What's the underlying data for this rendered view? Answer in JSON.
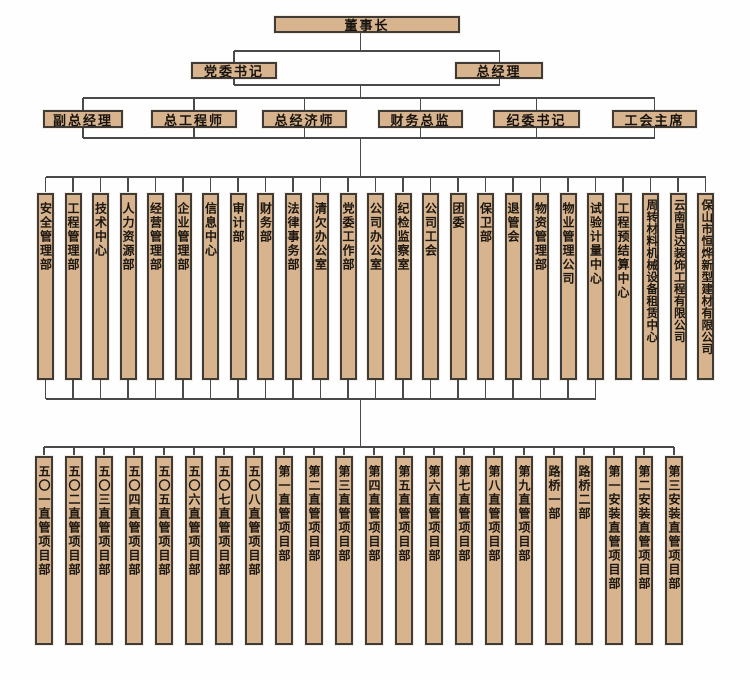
{
  "org": {
    "chairman": "董事长",
    "level2": [
      "党委书记",
      "总经理"
    ],
    "leaders": [
      "副总经理",
      "总工程师",
      "总经济师",
      "财务总监",
      "纪委书记",
      "工会主席"
    ],
    "departments": [
      "安全管理部",
      "工程管理部",
      "技术中心",
      "人力资源部",
      "经营管理部",
      "企业管理部",
      "信息中心",
      "审计部",
      "财务部",
      "法律事务部",
      "清欠办公室",
      "党委工作部",
      "公司办公室",
      "纪检监察室",
      "公司工会",
      "团委",
      "保卫部",
      "退管会",
      "物资管理部",
      "物业管理公司",
      "试验计量中心",
      "工程预结算中心",
      "周转材料机械设备租赁中心",
      "云南昌达装饰工程有限公司",
      "保山市恒烨新型建材有限公司"
    ],
    "departments_connected_to_projects": 21,
    "projects": [
      "五〇一直管项目部",
      "五〇二直管项目部",
      "五〇三直管项目部",
      "五〇四直管项目部",
      "五〇五直管项目部",
      "五〇六直管项目部",
      "五〇七直管项目部",
      "五〇八直管项目部",
      "第一直管项目部",
      "第二直管项目部",
      "第三直管项目部",
      "第四直管项目部",
      "第五直管项目部",
      "第六直管项目部",
      "第七直管项目部",
      "第八直管项目部",
      "第九直管项目部",
      "路桥一部",
      "路桥二部",
      "第一安装直管项目部",
      "第二安装直管项目部",
      "第三安装直管项目部"
    ]
  },
  "colors": {
    "box_fill": "#d7b48d",
    "box_border": "#3f3b36",
    "connector": "#4a4a4a",
    "text": "#1c1610",
    "background": "#fefefe"
  }
}
